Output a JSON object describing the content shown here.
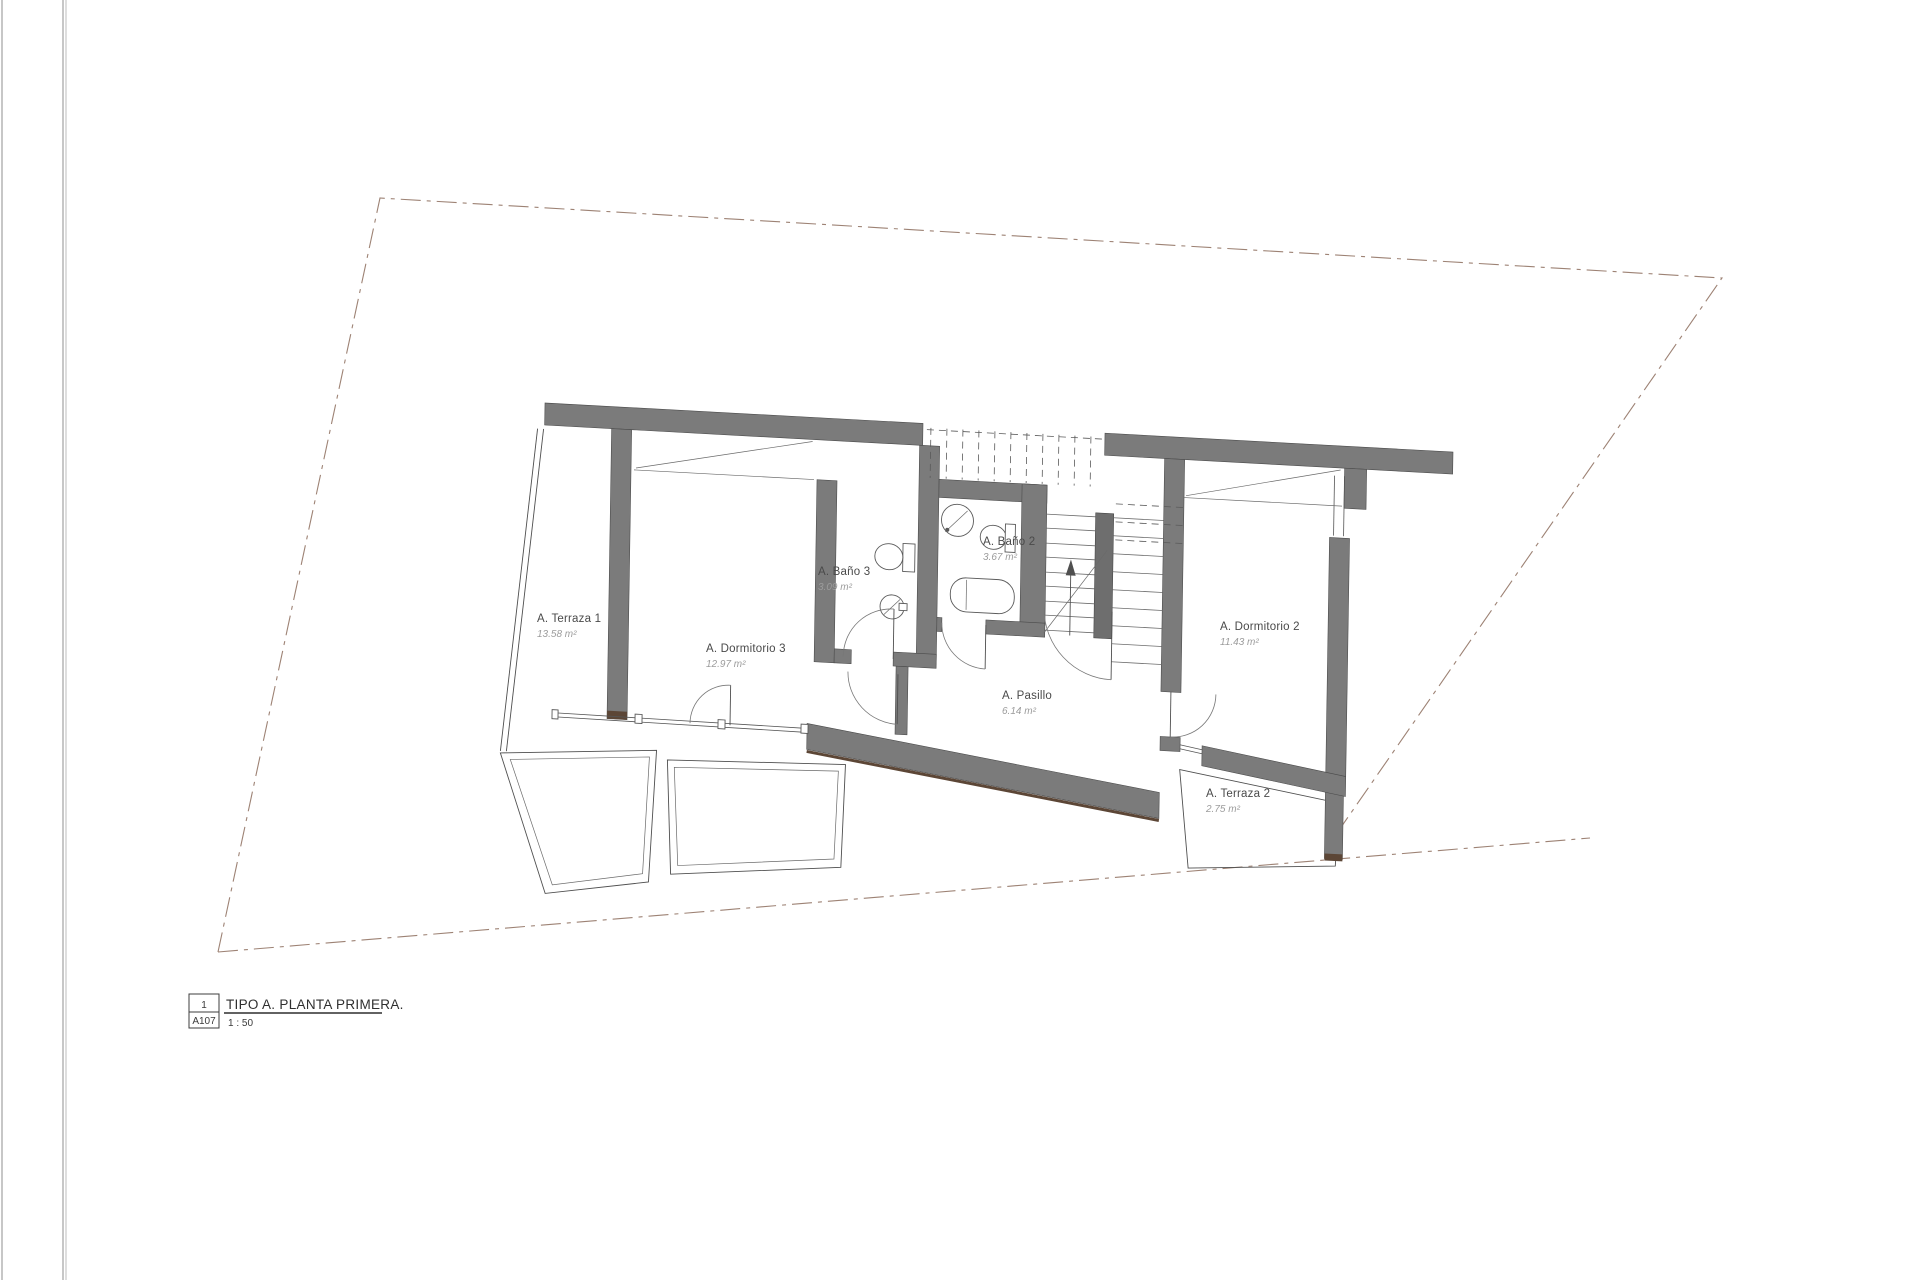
{
  "drawing": {
    "rooms": [
      {
        "name": "A. Terraza 1",
        "area": "13.58 m²"
      },
      {
        "name": "A. Dormitorio 3",
        "area": "12.97 m²"
      },
      {
        "name": "A. Baño 3",
        "area": "3.09 m²"
      },
      {
        "name": "A. Baño 2",
        "area": "3.67 m²"
      },
      {
        "name": "A. Pasillo",
        "area": "6.14 m²"
      },
      {
        "name": "A. Dormitorio 2",
        "area": "11.43 m²"
      },
      {
        "name": "A. Terraza 2",
        "area": "2.75 m²"
      }
    ],
    "title_block": {
      "detail_number": "1",
      "sheet_number": "A107",
      "title": "TIPO A. PLANTA PRIMERA.",
      "scale": "1 : 50"
    },
    "colors": {
      "wall_gray": "#7b7b7b",
      "accent_brown": "#5c4636",
      "plot_boundary": "#9d8274",
      "label_gray": "#4a4a4a",
      "area_gray": "#9c9c9c"
    }
  }
}
